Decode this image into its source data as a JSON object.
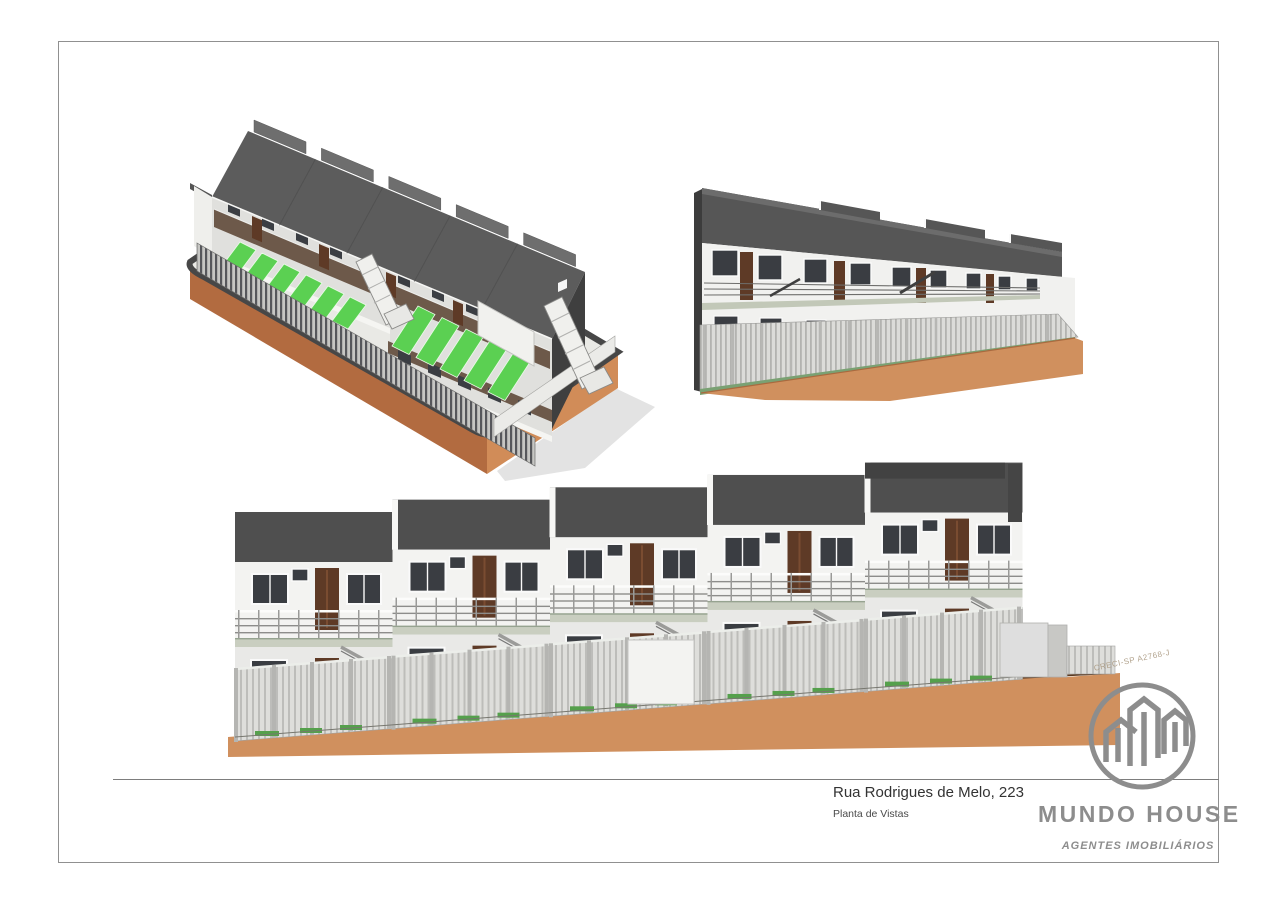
{
  "sheet": {
    "title": "Rua Rodrigues de Melo, 223",
    "subtitle": "Planta de Vistas"
  },
  "brand": {
    "name": "MUNDO HOUSE",
    "tagline": "AGENTES IMOBILIÁRIOS",
    "registration_watermark": "CRECI-SP A2768-J",
    "logo_icon": "buildings-outline-in-circle-icon"
  },
  "views": {
    "isometric": "3d-isometric-building-view",
    "perspective": "3d-perspective-facade-view",
    "elevation": "front-elevation-view"
  },
  "palette": {
    "page": "#ffffff",
    "border": "#909090",
    "roof": "#515151",
    "roof_light": "#6e6e6e",
    "wall": "#f2f2f0",
    "wall_shade": "#e0e0dd",
    "glass": "#3a3d42",
    "door_brown": "#5e3a26",
    "balcony_screen": "#6d594a",
    "railing": "#8a8a88",
    "fence": "#d9d9d6",
    "slab": "#c9cec0",
    "parking_green": "#5bd052",
    "grass_green": "#57a54e",
    "earth": "#d0905e",
    "earth_shade": "#b26b40",
    "logo_gray": "#8d8d8d",
    "text": "#333333"
  }
}
